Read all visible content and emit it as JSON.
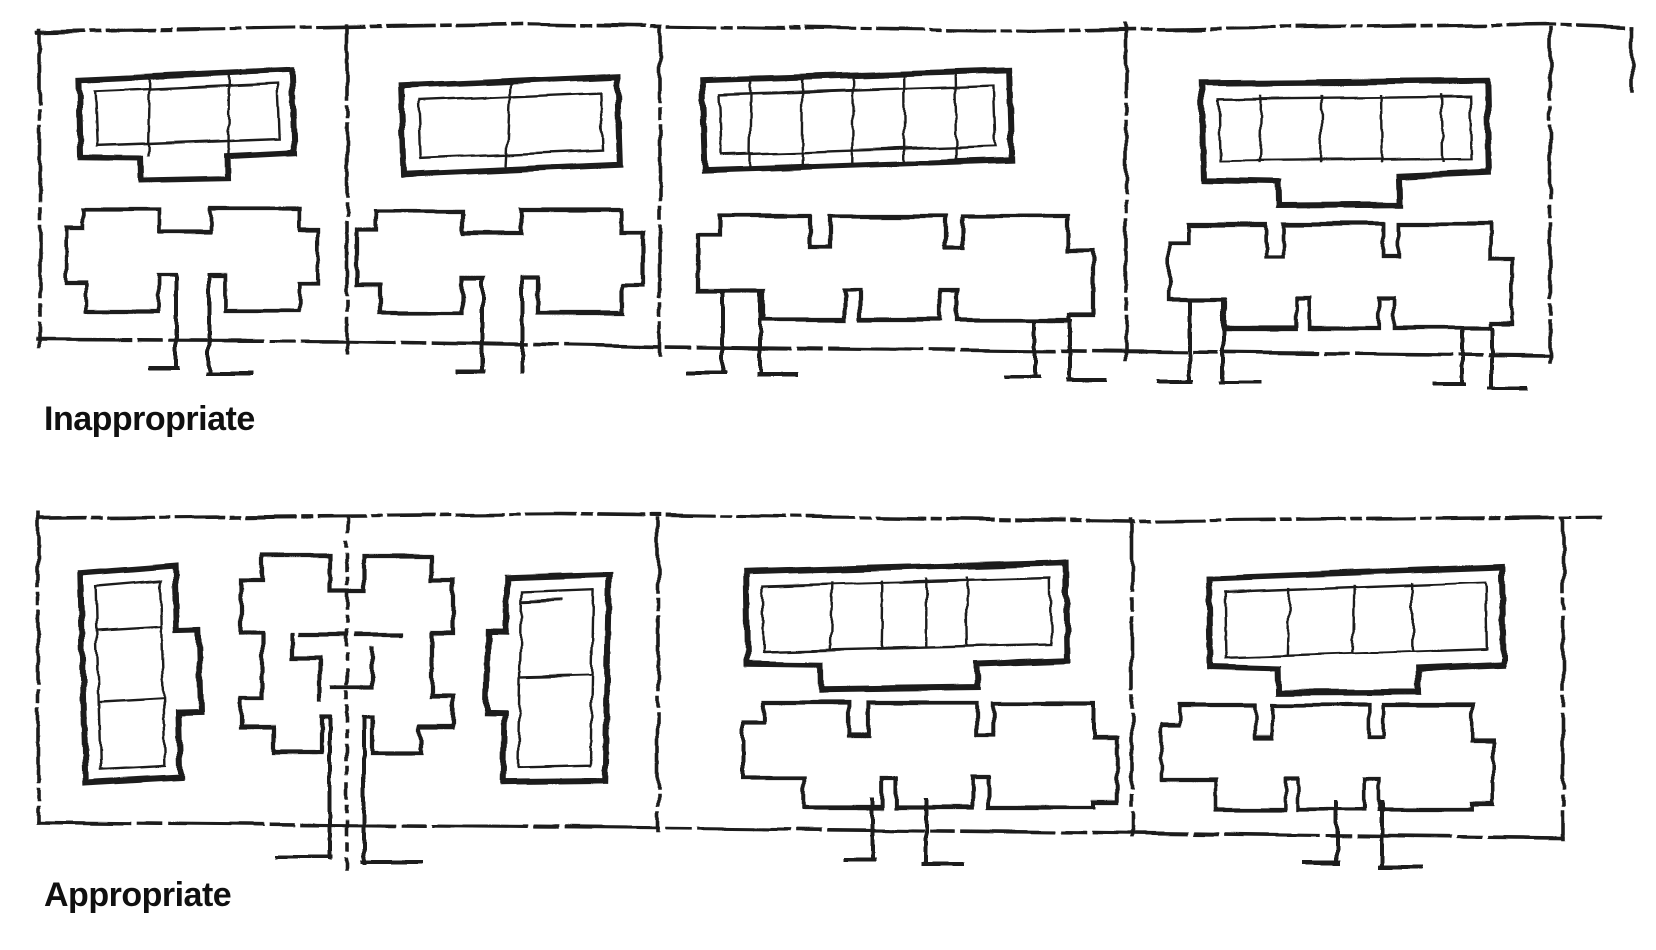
{
  "figure": {
    "kind": "hand-drawn site plan guideline sketch",
    "colors": {
      "ink": "#1b1b1b",
      "paper": "#ffffff"
    },
    "panels": [
      {
        "id": "inappropriate",
        "label": "Inappropriate",
        "lots": 4
      },
      {
        "id": "appropriate",
        "label": "Appropriate",
        "lots": 3
      }
    ]
  }
}
